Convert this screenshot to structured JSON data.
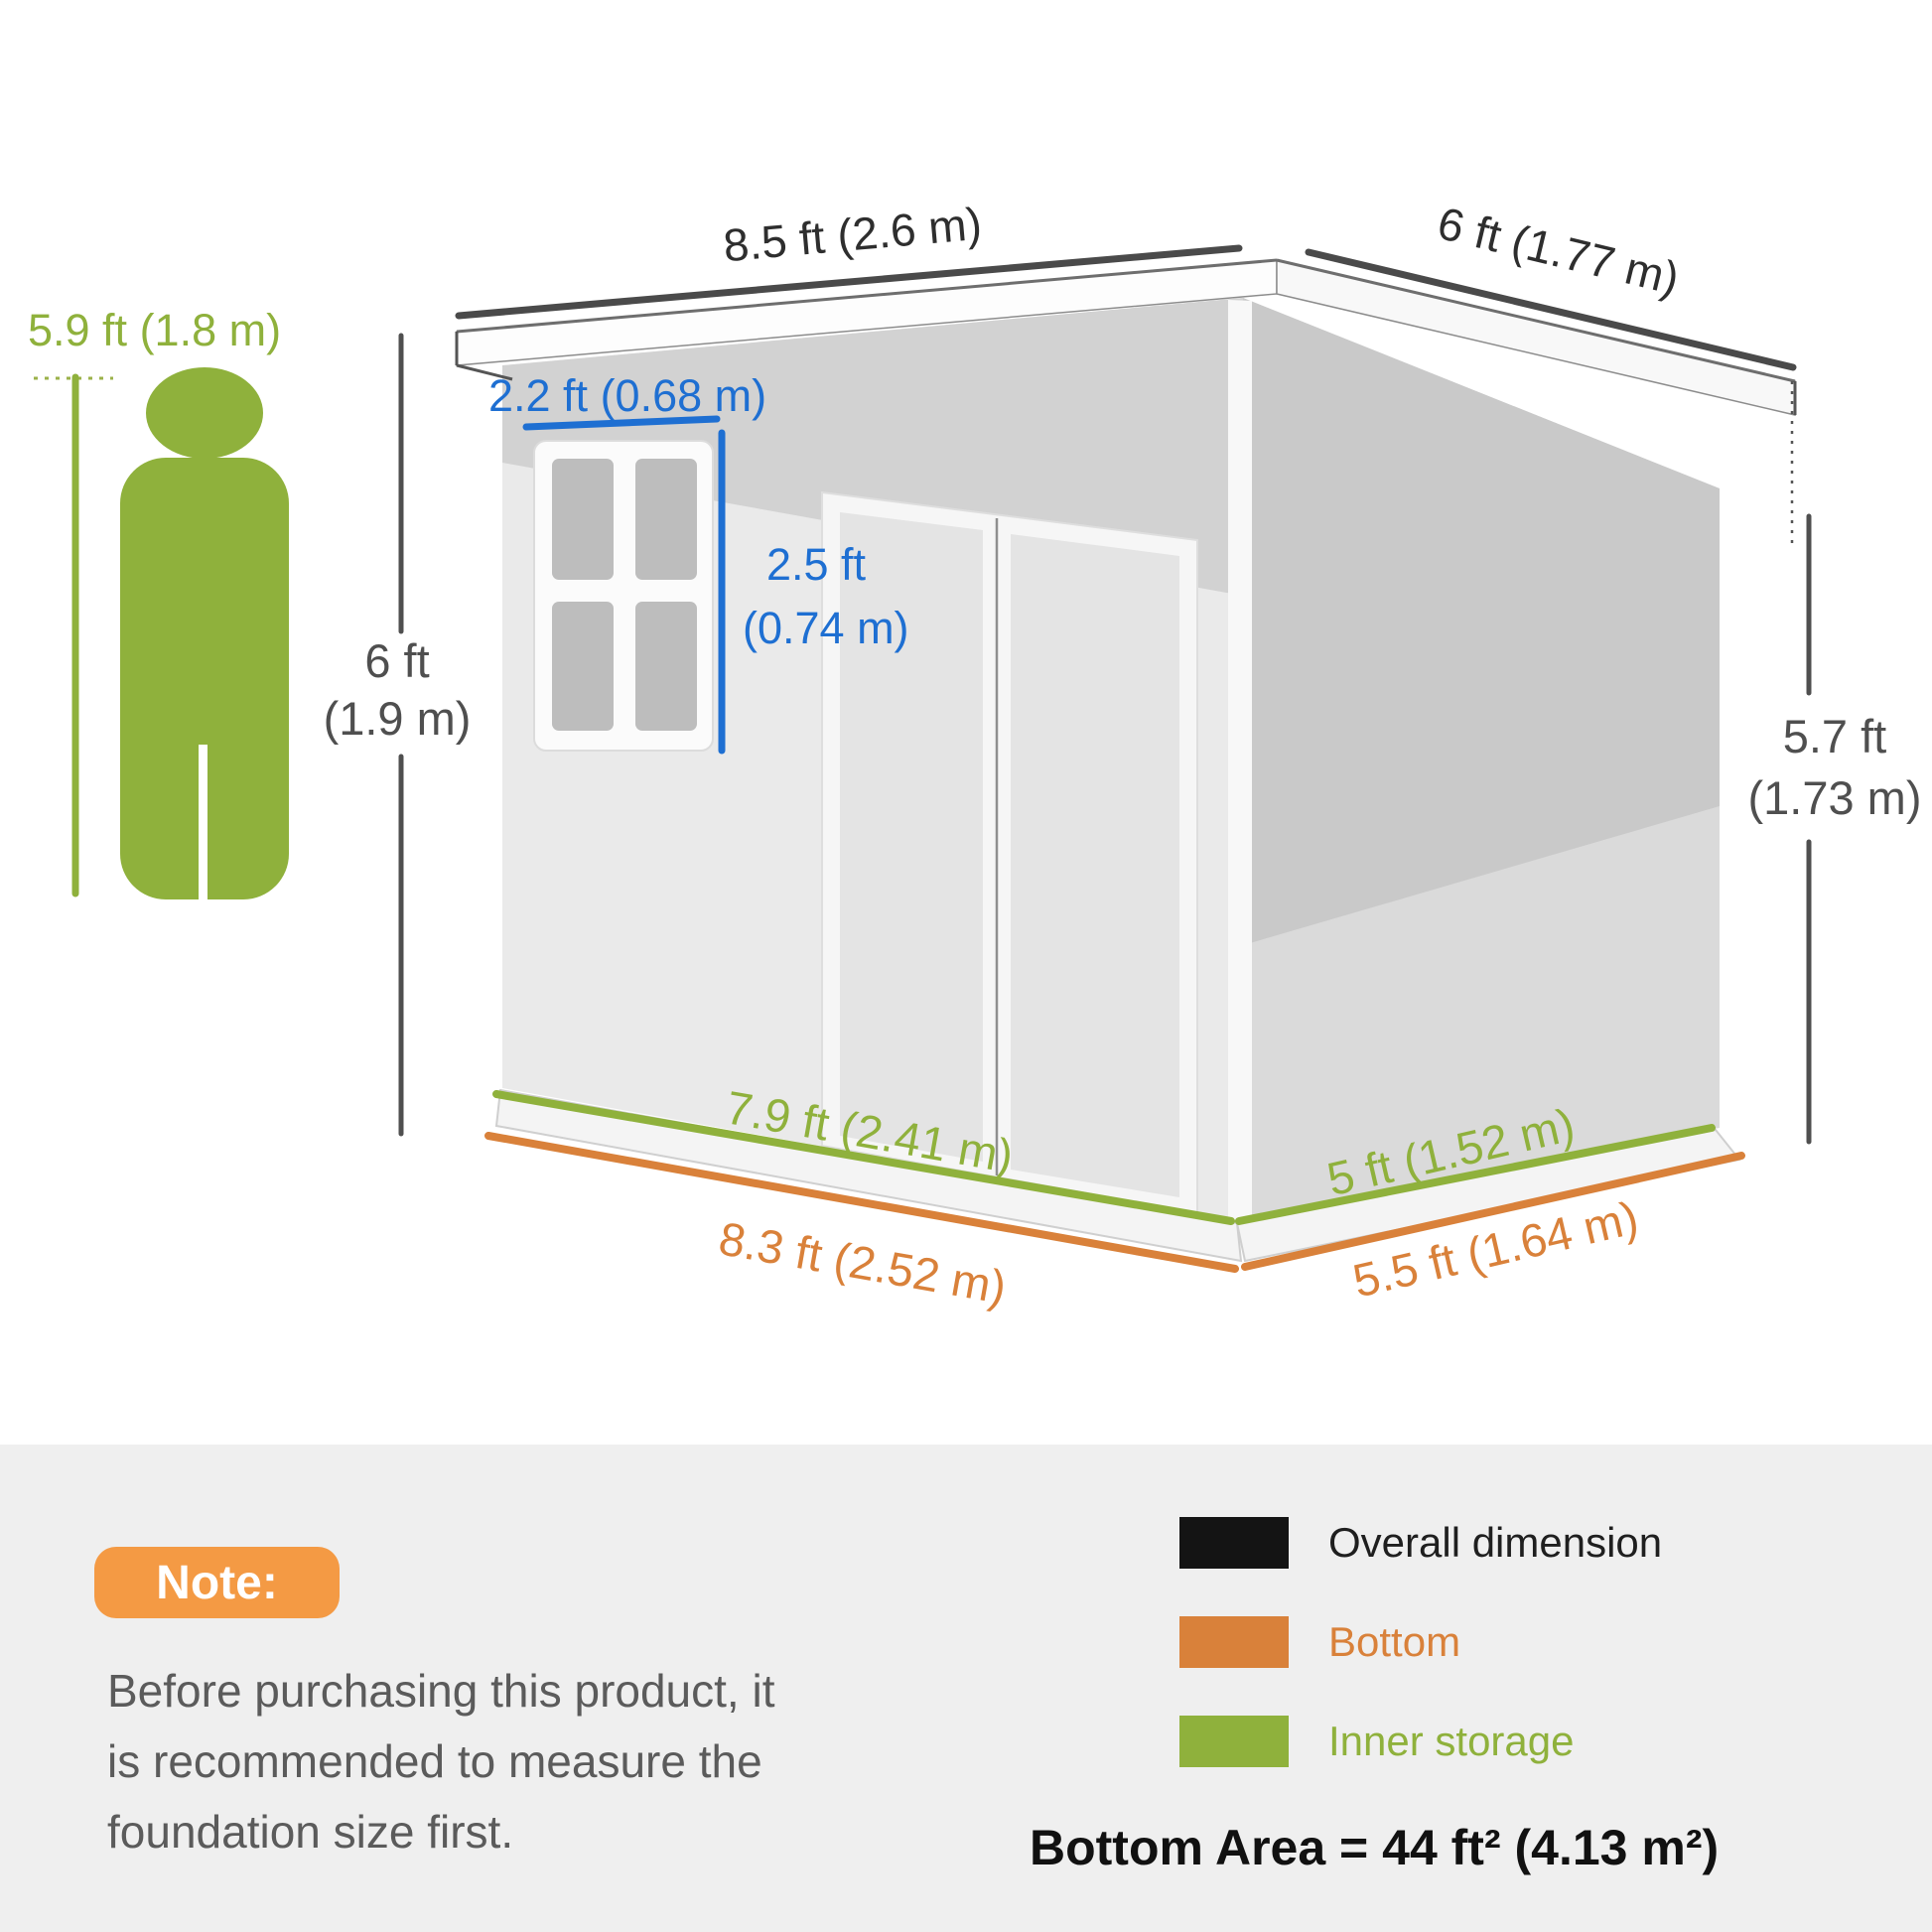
{
  "person": {
    "height_label": "5.9 ft (1.8 m)"
  },
  "dimensions": {
    "overall_width": "8.5 ft (2.6 m)",
    "overall_depth": "6 ft (1.77 m)",
    "overall_height_left_line1": "6 ft",
    "overall_height_left_line2": "(1.9 m)",
    "overall_height_right_line1": "5.7 ft",
    "overall_height_right_line2": "(1.73 m)",
    "window_width": "2.2 ft (0.68 m)",
    "window_height_line1": "2.5 ft",
    "window_height_line2": "(0.74 m)",
    "inner_width": "7.9 ft (2.41 m)",
    "inner_depth": "5 ft (1.52 m)",
    "bottom_width": "8.3 ft (2.52 m)",
    "bottom_depth": "5.5 ft (1.64 m)"
  },
  "note": {
    "badge": "Note:",
    "line1": "Before purchasing this product, it",
    "line2": "is recommended to measure the",
    "line3": "foundation size first."
  },
  "legend": {
    "items": [
      {
        "label": "Overall dimension",
        "color": "#141414"
      },
      {
        "label": "Bottom",
        "color": "#d9813a"
      },
      {
        "label": "Inner storage",
        "color": "#8fb13c"
      }
    ],
    "bottom_area": "Bottom Area = 44 ft² (4.13 m²)"
  },
  "colors": {
    "overall_dimension": "#4a4a4a",
    "bottom_dimension": "#d9813a",
    "inner_storage": "#8fb13c",
    "window_dimension_blue": "#1e6fd2",
    "note_badge_orange": "#f49a44",
    "footer_background": "#efefef"
  }
}
